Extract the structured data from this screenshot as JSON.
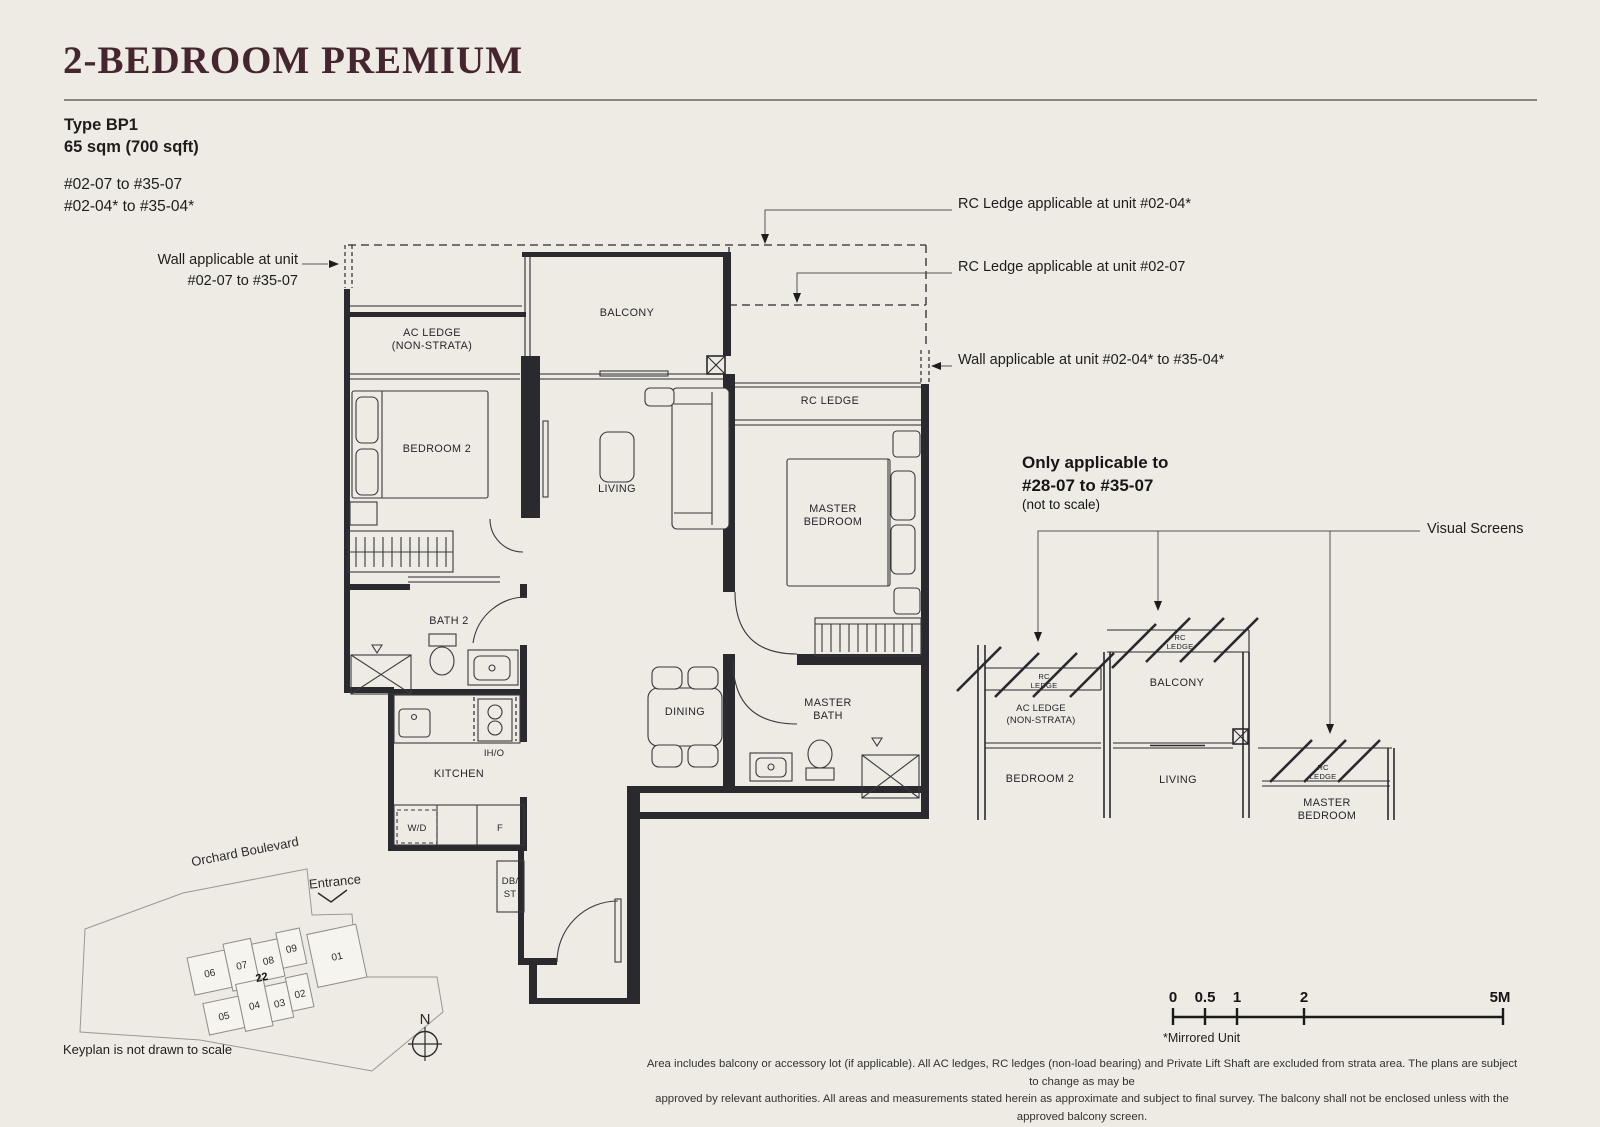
{
  "header": {
    "title": "2-BEDROOM PREMIUM",
    "type_label": "Type BP1",
    "area_label": "65 sqm (700 sqft)",
    "unit_range_1": "#02-07 to #35-07",
    "unit_range_2": "#02-04* to #35-04*"
  },
  "callouts": {
    "rc_ledge_02_04": "RC Ledge applicable at unit #02-04*",
    "rc_ledge_02_07": "RC Ledge applicable at unit #02-07",
    "wall_02_04": "Wall applicable at unit #02-04* to #35-04*",
    "wall_02_07_l1": "Wall applicable at unit",
    "wall_02_07_l2": "#02-07 to #35-07",
    "visual_screens": "Visual Screens"
  },
  "plan_labels": {
    "balcony": "BALCONY",
    "ac_ledge_l1": "AC LEDGE",
    "ac_ledge_l2": "(NON-STRATA)",
    "bedroom2": "BEDROOM 2",
    "living": "LIVING",
    "rc_ledge": "RC LEDGE",
    "master_l1": "MASTER",
    "master_l2": "BEDROOM",
    "bath2": "BATH 2",
    "dining": "DINING",
    "master_bath_l1": "MASTER",
    "master_bath_l2": "BATH",
    "kitchen": "KITCHEN",
    "iho": "IH/O",
    "wd": "W/D",
    "fridge": "F",
    "db_l1": "DB/",
    "db_l2": "ST"
  },
  "section": {
    "title_l1": "Only applicable to",
    "title_l2": "#28-07 to #35-07",
    "subtitle": "(not to scale)",
    "rc_l1": "RC",
    "rc_l2": "LEDGE",
    "ac_ledge_l1": "AC LEDGE",
    "ac_ledge_l2": "(NON-STRATA)",
    "bedroom2": "BEDROOM 2",
    "balcony": "BALCONY",
    "living": "LIVING",
    "master_l1": "MASTER",
    "master_l2": "BEDROOM"
  },
  "keyplan": {
    "street": "Orchard Boulevard",
    "entrance": "Entrance",
    "note": "Keyplan is not drawn to scale",
    "north": "N",
    "units": {
      "u06": "06",
      "u07": "07",
      "u08": "08",
      "u09": "09",
      "u22": "22",
      "u01": "01",
      "u05": "05",
      "u04": "04",
      "u03": "03",
      "u02": "02"
    },
    "highlight_color": "#b9ccc0"
  },
  "scalebar": {
    "t0": "0",
    "t05": "0.5",
    "t1": "1",
    "t2": "2",
    "t5": "5M",
    "mirrored": "*Mirrored Unit"
  },
  "disclaimer": {
    "l1": "Area includes balcony or accessory lot (if applicable). All AC ledges, RC ledges (non-load bearing) and Private Lift Shaft are excluded from strata area. The plans are subject to change as may be",
    "l2": "approved by relevant authorities. All areas and measurements stated herein as approximate and subject to final survey. The balcony shall not be enclosed unless with the approved balcony screen."
  }
}
